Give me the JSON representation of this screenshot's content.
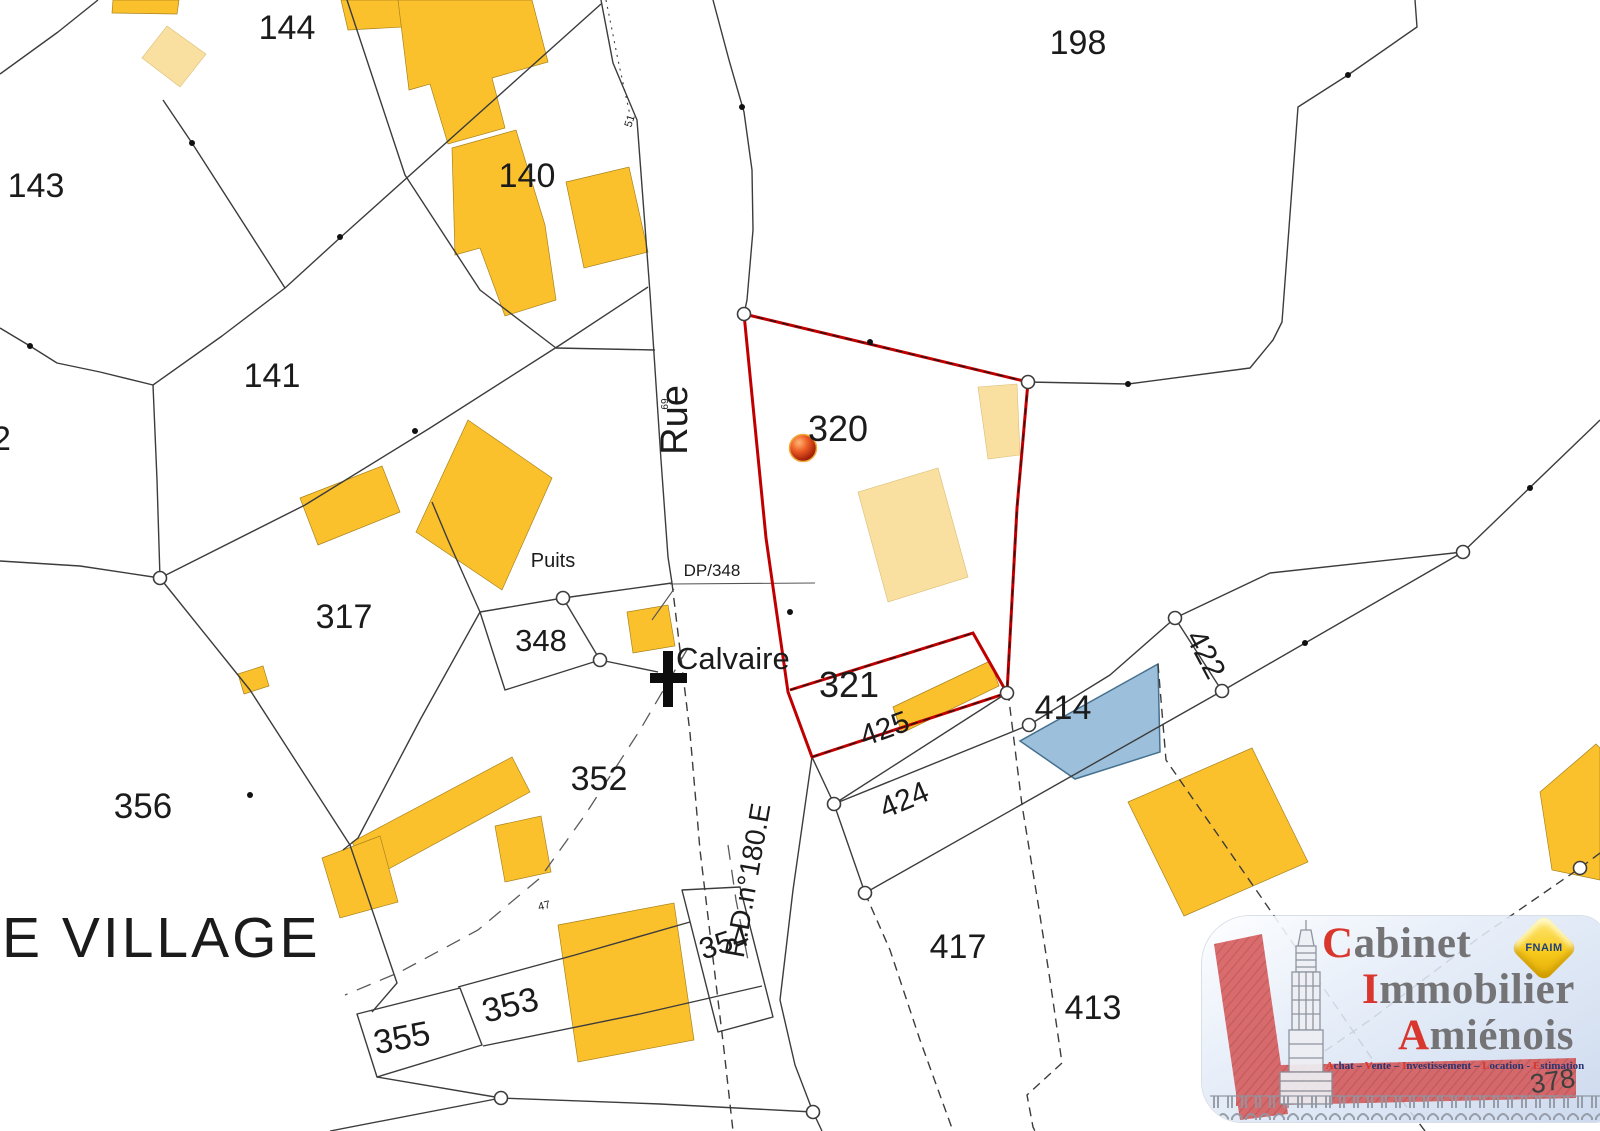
{
  "map": {
    "colors": {
      "building": "#FBC12D",
      "building_annex": "#FAE0A0",
      "selected_parcel_outline": "#C00000",
      "highlight_parcel_fill": "#9CC0DC",
      "boundary_line": "#3C3C3C",
      "label_text": "#1B1B1B"
    },
    "icons": [
      {
        "name": "calvaire-cross-icon",
        "meaning": "wayside cross landmark"
      },
      {
        "name": "location-marker-sphere-icon",
        "meaning": "red sphere marking parcel 320"
      },
      {
        "name": "corner-marker-icon",
        "meaning": "small circle at boundary corners"
      },
      {
        "name": "boundary-dot-icon",
        "meaning": "small black point on boundary lines"
      }
    ],
    "labels": [
      {
        "text": "144",
        "kind": "parcel-number",
        "x": 287,
        "y": 39,
        "size": 34
      },
      {
        "text": "198",
        "kind": "parcel-number",
        "x": 1078,
        "y": 54,
        "size": 34
      },
      {
        "text": "143",
        "kind": "parcel-number",
        "x": 36,
        "y": 197,
        "size": 34
      },
      {
        "text": "140",
        "kind": "parcel-number",
        "x": 527,
        "y": 187,
        "size": 34
      },
      {
        "text": "2",
        "kind": "parcel-number",
        "x": -8,
        "y": 450,
        "size": 34,
        "anchor": "start"
      },
      {
        "text": "141",
        "kind": "parcel-number",
        "x": 272,
        "y": 387,
        "size": 34
      },
      {
        "text": "317",
        "kind": "parcel-number",
        "x": 344,
        "y": 628,
        "size": 34
      },
      {
        "text": "348",
        "kind": "parcel-number",
        "x": 541,
        "y": 651,
        "size": 31
      },
      {
        "text": "352",
        "kind": "parcel-number",
        "x": 599,
        "y": 790,
        "size": 34
      },
      {
        "text": "356",
        "kind": "parcel-number",
        "x": 143,
        "y": 818,
        "size": 35
      },
      {
        "text": "320",
        "kind": "parcel-number",
        "x": 838,
        "y": 441,
        "size": 36
      },
      {
        "text": "321",
        "kind": "parcel-number",
        "x": 849,
        "y": 697,
        "size": 36
      },
      {
        "text": "425",
        "kind": "parcel-number",
        "x": 888,
        "y": 738,
        "size": 30,
        "rot": -20
      },
      {
        "text": "424",
        "kind": "parcel-number",
        "x": 908,
        "y": 809,
        "size": 30,
        "rot": -23
      },
      {
        "text": "422",
        "kind": "parcel-number",
        "x": 1197,
        "y": 659,
        "size": 30,
        "rot": 62
      },
      {
        "text": "414",
        "kind": "parcel-number",
        "x": 1063,
        "y": 719,
        "size": 34
      },
      {
        "text": "417",
        "kind": "parcel-number",
        "x": 958,
        "y": 958,
        "size": 34
      },
      {
        "text": "413",
        "kind": "parcel-number",
        "x": 1093,
        "y": 1019,
        "size": 34
      },
      {
        "text": "354",
        "kind": "parcel-number",
        "x": 727,
        "y": 952,
        "size": 30,
        "rot": -18
      },
      {
        "text": "353",
        "kind": "parcel-number",
        "x": 513,
        "y": 1016,
        "size": 34,
        "rot": -14
      },
      {
        "text": "355",
        "kind": "parcel-number",
        "x": 404,
        "y": 1049,
        "size": 34,
        "rot": -11
      },
      {
        "text": "Rue",
        "kind": "street",
        "x": 687,
        "y": 420,
        "size": 38,
        "rot": -90
      },
      {
        "text": "69",
        "kind": "measure",
        "x": 668,
        "y": 404,
        "size": 10,
        "rot": -90
      },
      {
        "text": "51",
        "kind": "measure",
        "x": 633,
        "y": 122,
        "size": 11,
        "rot": -72
      },
      {
        "text": "47",
        "kind": "measure",
        "x": 545,
        "y": 909,
        "size": 11,
        "rot": -14
      },
      {
        "text": "R.D.n°180.E",
        "kind": "street",
        "x": 757,
        "y": 882,
        "size": 28,
        "rot": -80
      },
      {
        "text": "Puits",
        "kind": "landmark",
        "x": 553,
        "y": 567,
        "size": 20
      },
      {
        "text": "DP/348",
        "kind": "landmark",
        "x": 712,
        "y": 576,
        "size": 17
      },
      {
        "text": "Calvaire",
        "kind": "landmark",
        "x": 676,
        "y": 669,
        "size": 31,
        "anchor": "start"
      },
      {
        "text": "E VILLAGE",
        "kind": "place-name",
        "x": 2,
        "y": 957,
        "size": 57,
        "anchor": "start",
        "spacing": 3
      },
      {
        "text": "378",
        "kind": "parcel-number",
        "x": 1554,
        "y": 1090,
        "size": 27,
        "rot": -9,
        "layer": "top",
        "color": "#3f3f3f"
      }
    ]
  },
  "logo": {
    "title_lines": [
      {
        "initial": "C",
        "rest": "abinet"
      },
      {
        "initial": "I",
        "rest": "mmobilier"
      },
      {
        "initial": "A",
        "rest": "miénois"
      }
    ],
    "tagline": {
      "words": [
        "Achat",
        "Vente",
        "Investissement",
        "Location",
        "Estimation"
      ],
      "separators": [
        " – ",
        " – ",
        " – ",
        " - "
      ]
    },
    "badge": "FNAIM"
  }
}
